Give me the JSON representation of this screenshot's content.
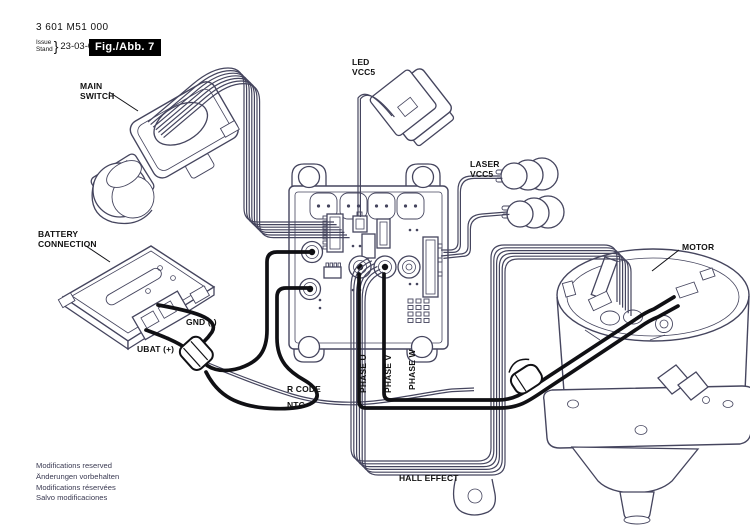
{
  "header": {
    "part_number": "3 601 M51 000",
    "issue_label_top": "Issue",
    "issue_label_bottom": "Stand",
    "issue_brace": "}",
    "issue_date": "23-03-09",
    "figure_label": "Fig./Abb. 7"
  },
  "component_labels": {
    "main_switch": "MAIN SWITCH",
    "led": "LED VCC5",
    "laser": "LASER VCC5",
    "battery": "BATTERY CONNECTION",
    "motor": "MOTOR"
  },
  "wire_labels": {
    "gnd": "GND (-)",
    "ubat": "UBAT (+)",
    "r_code": "R CODE",
    "ntc": "NTC",
    "phase_u": "PHASE U",
    "phase_v": "PHASE V",
    "phase_w": "PHASE W",
    "hall_effect": "HALL EFFECT"
  },
  "footer": {
    "lines": [
      "Modifications reserved",
      "Änderungen vorbehalten",
      "Modifications réservées",
      "Salvo modificaciones"
    ]
  },
  "colors": {
    "outline": "#45455e",
    "wire": "#101014",
    "label_text": "#111111",
    "figure_box_bg": "#000000",
    "figure_box_text": "#ffffff"
  }
}
